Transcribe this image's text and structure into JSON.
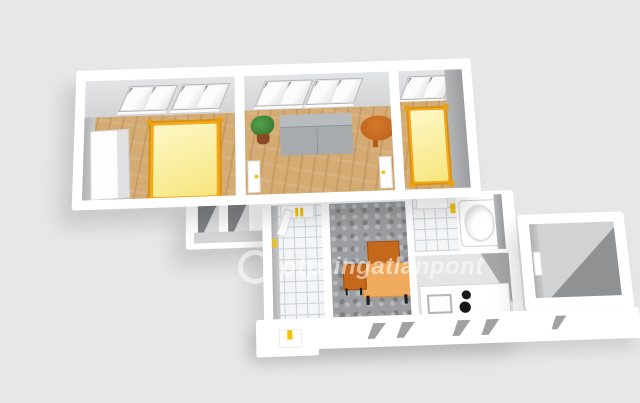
{
  "scene": {
    "type": "3d-floorplan-render",
    "background": "#e7e7e8"
  },
  "watermark": {
    "logo_icon": "otp-ring-logo",
    "brand": "otp",
    "suffix": "ingatlanpont",
    "color": "rgba(255,255,255,0.55)"
  },
  "palette": {
    "wall_white": "#ffffff",
    "wall_inner_light": "#dcdddf",
    "wall_inner_dark": "#a2a4a6",
    "wood_floor": "#d5ab74",
    "tile_floor": "#f3f5f7",
    "mosaic_floor": "#9b9da0",
    "hall_floor": "#d2d4d6",
    "bed_frame": "#f3a81f",
    "bed_mattress": "#fbf2a9",
    "sofa": "#a8abae",
    "round_table": "#c9681e",
    "desk": "#f0aa5e",
    "chair": "#c4681c",
    "plant_leaves": "#3f8f3a",
    "plant_pot": "#8a4a21",
    "accent_yellow": "#f2c40f",
    "burner_black": "#161616"
  },
  "rooms": [
    {
      "id": "bedroom-1",
      "floor": "wood",
      "furniture": [
        "double-bed",
        "wardrobe",
        "two-windows"
      ]
    },
    {
      "id": "living-room",
      "floor": "wood",
      "furniture": [
        "sofa",
        "potted-plant",
        "round-table",
        "two-windows",
        "two-doors"
      ]
    },
    {
      "id": "bedroom-2",
      "floor": "wood",
      "furniture": [
        "single-bed",
        "window"
      ]
    },
    {
      "id": "hallway",
      "floor": "gray",
      "furniture": [
        "door-openings"
      ]
    },
    {
      "id": "wc",
      "floor": "tile",
      "furniture": [
        "door"
      ]
    },
    {
      "id": "dining",
      "floor": "mosaic",
      "furniture": [
        "desk",
        "chair"
      ]
    },
    {
      "id": "bathroom",
      "floor": "tile",
      "furniture": [
        "bathtub"
      ]
    },
    {
      "id": "kitchen",
      "floor": "gray",
      "furniture": [
        "counter",
        "sink",
        "stove"
      ]
    },
    {
      "id": "entry",
      "floor": "gray",
      "furniture": []
    }
  ]
}
